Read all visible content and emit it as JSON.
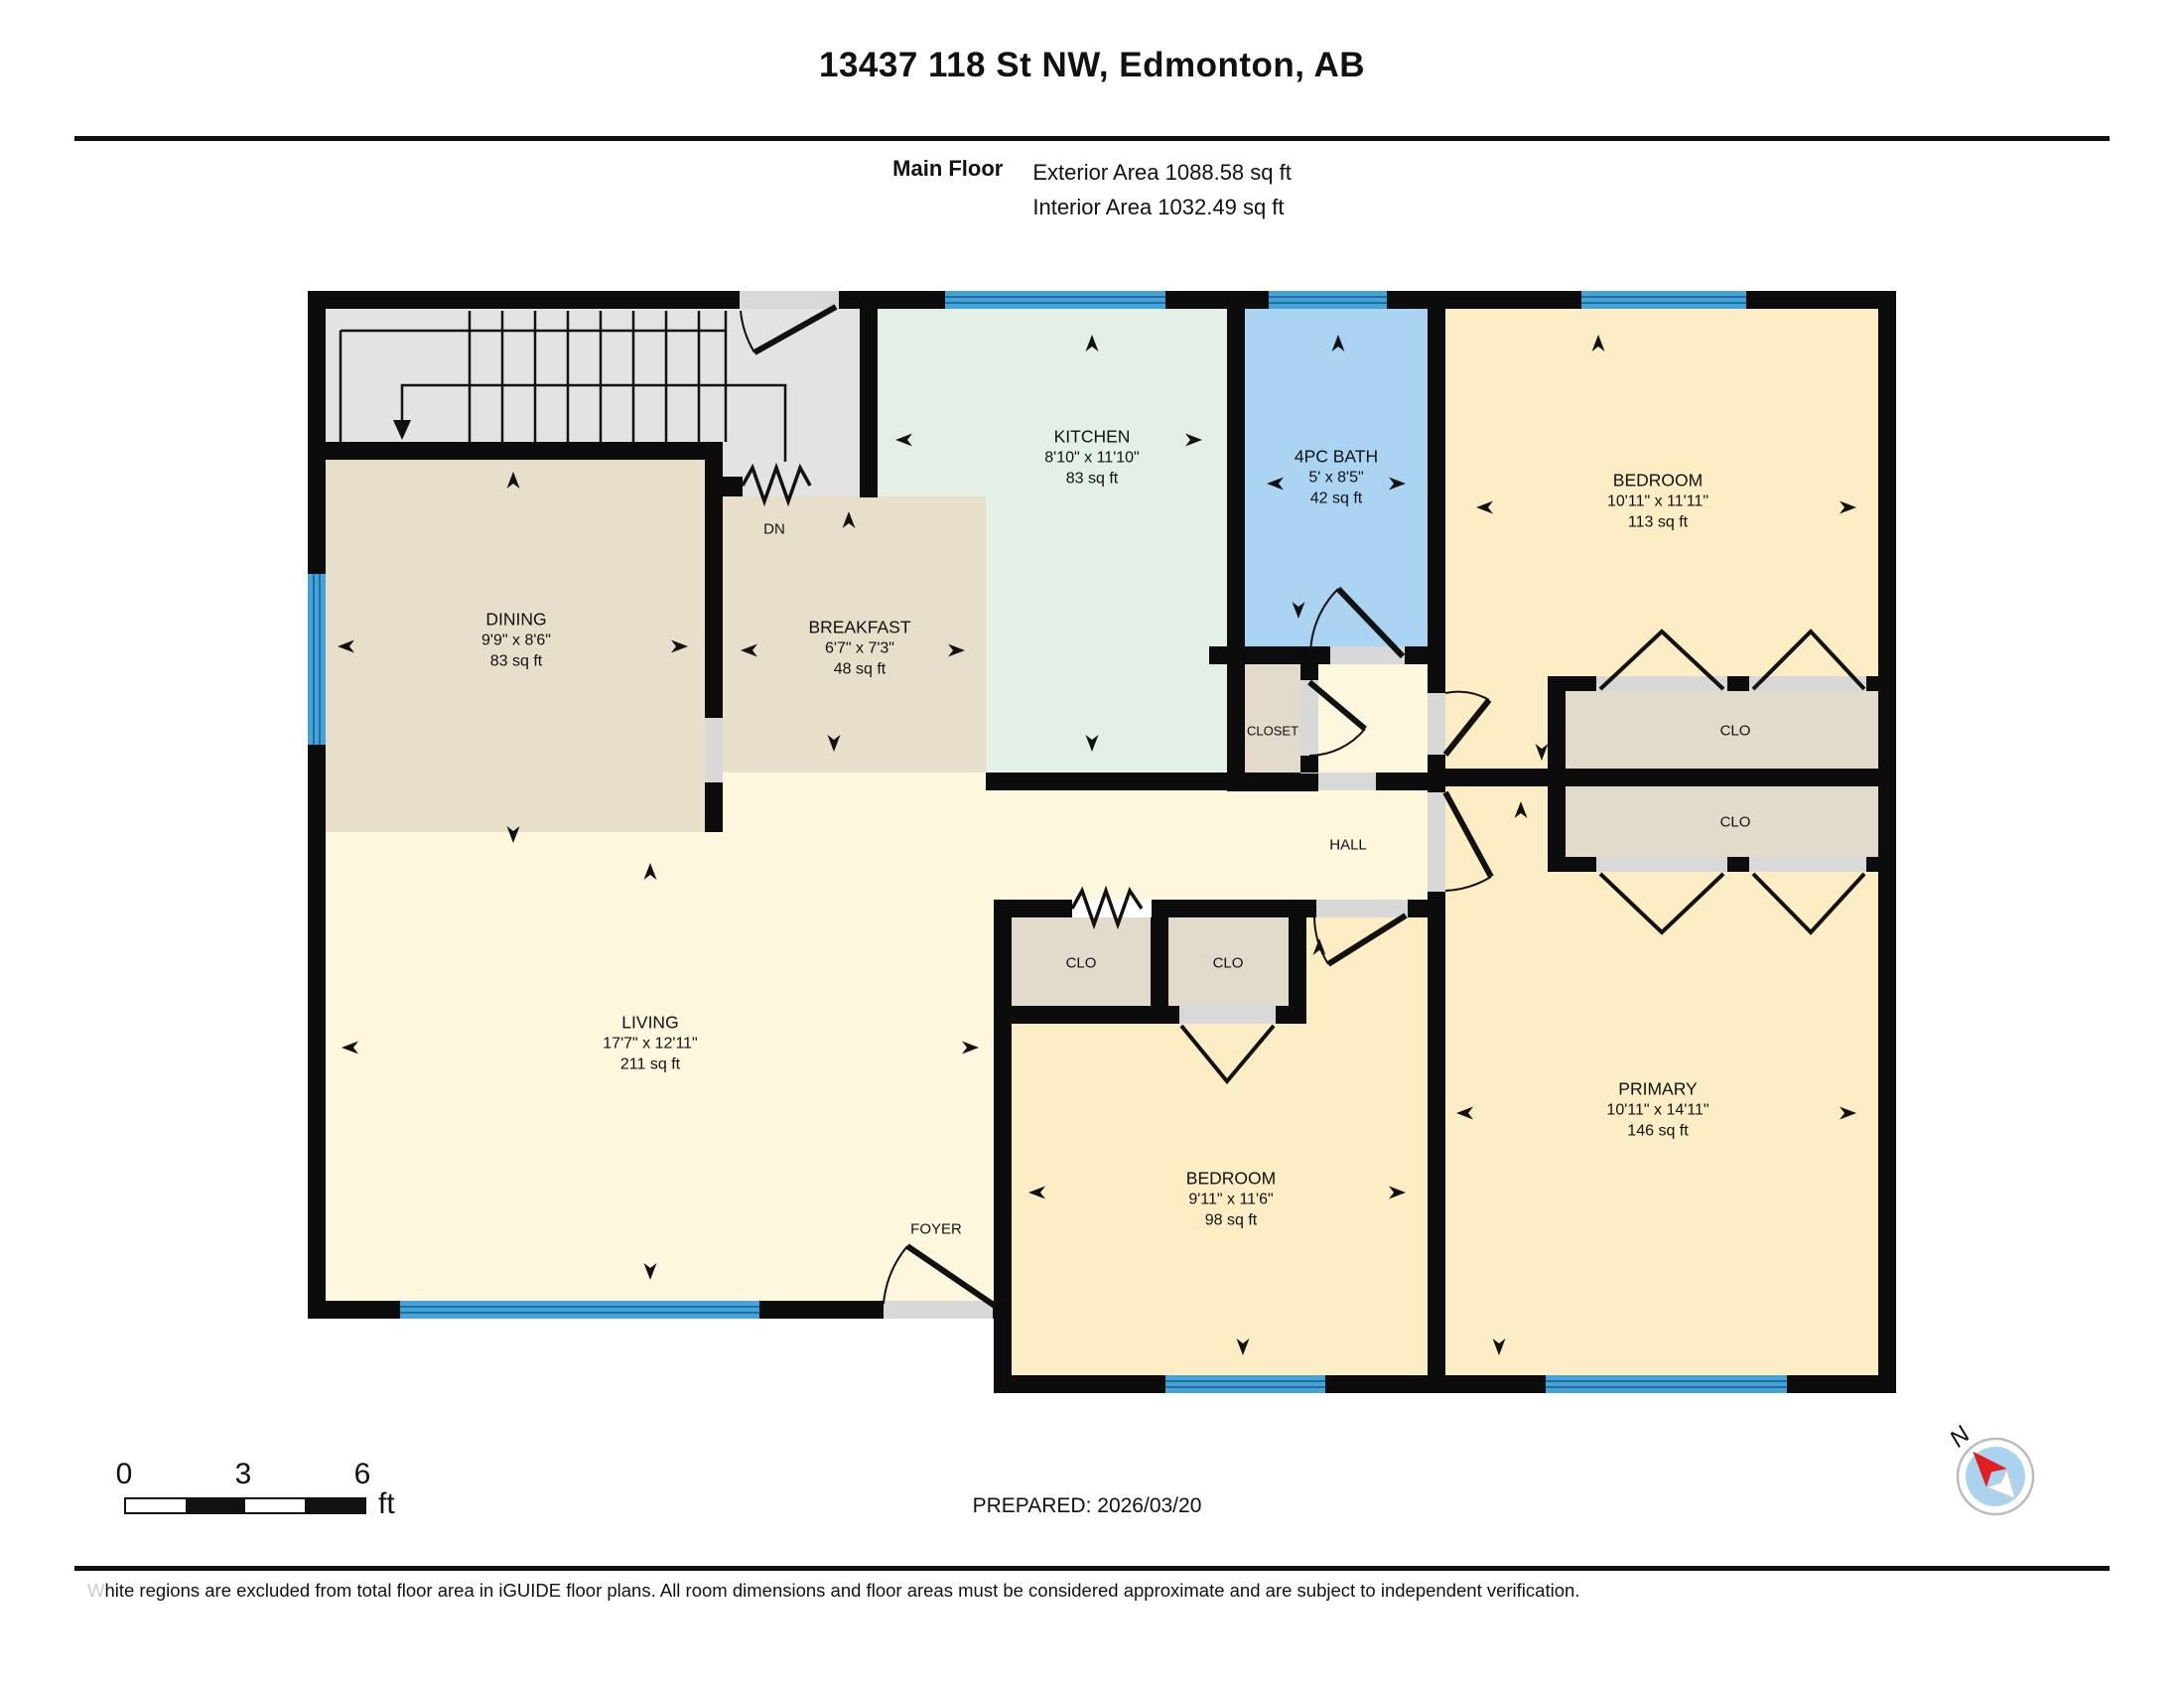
{
  "header": {
    "title": "13437 118 St NW, Edmonton, AB",
    "floor_label": "Main Floor",
    "exterior_area": "Exterior Area 1088.58 sq ft",
    "interior_area": "Interior Area 1032.49 sq ft"
  },
  "rooms": {
    "dining": {
      "name": "DINING",
      "dims": "9'9\" x 8'6\"",
      "area": "83 sq ft"
    },
    "breakfast": {
      "name": "BREAKFAST",
      "dims": "6'7\" x 7'3\"",
      "area": "48 sq ft"
    },
    "kitchen": {
      "name": "KITCHEN",
      "dims": "8'10\" x 11'10\"",
      "area": "83 sq ft"
    },
    "bath": {
      "name": "4PC BATH",
      "dims": "5' x 8'5\"",
      "area": "42 sq ft"
    },
    "bedroom_top": {
      "name": "BEDROOM",
      "dims": "10'11\" x 11'11\"",
      "area": "113 sq ft"
    },
    "living": {
      "name": "LIVING",
      "dims": "17'7\" x 12'11\"",
      "area": "211 sq ft"
    },
    "bedroom_bottom": {
      "name": "BEDROOM",
      "dims": "9'11\" x 11'6\"",
      "area": "98 sq ft"
    },
    "primary": {
      "name": "PRIMARY",
      "dims": "10'11\" x 14'11\"",
      "area": "146 sq ft"
    }
  },
  "labels": {
    "closet": "CLOSET",
    "clo": "CLO",
    "hall": "HALL",
    "foyer": "FOYER",
    "down": "DN"
  },
  "scale_bar": {
    "tick_0": "0",
    "tick_3": "3",
    "tick_6": "6",
    "unit": "ft"
  },
  "footer": {
    "prepared": "PREPARED: 2026/03/20",
    "disclaimer_first_letter": "W",
    "disclaimer_rest": "hite regions are excluded from total floor area in iGUIDE floor plans. All room dimensions and floor areas must be considered approximate and are subject to independent verification.",
    "compass_north": "N"
  },
  "colors": {
    "wall": "#0c0c0c",
    "window": "#45a3d9",
    "window_stripe": "#1d6f9e",
    "gray": "#e3e3e3",
    "sill": "#d8d8d8",
    "tan": "#e7dfca",
    "closet_tan": "#e2dacb",
    "mint": "#e4efe6",
    "bath_blue": "#aad4f1",
    "yellow": "#fcedc5",
    "cream": "#fdf7de",
    "compass_red": "#e02020",
    "compass_blue": "#a9d3ef",
    "line": "#111111"
  }
}
